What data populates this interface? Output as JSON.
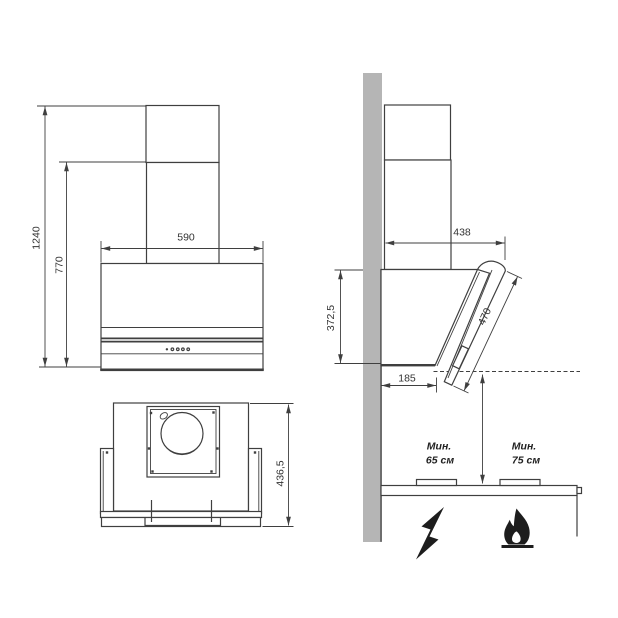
{
  "colors": {
    "line": "#3f3f3f",
    "wall": "#b5b5b5",
    "icon": "#1d1d1d",
    "text": "#333333"
  },
  "front_view": {
    "dim_height_total": "1240",
    "dim_height_body": "770",
    "dim_width": "590"
  },
  "side_view": {
    "dim_depth": "438",
    "dim_height_body": "372,5",
    "dim_panel_length": "470",
    "dim_depth_bottom": "185"
  },
  "top_view": {
    "dim_depth": "436,5"
  },
  "installation_view": {
    "electric": {
      "line1": "Мин.",
      "line2": "65 см"
    },
    "gas": {
      "line1": "Мин.",
      "line2": "75 см"
    }
  }
}
